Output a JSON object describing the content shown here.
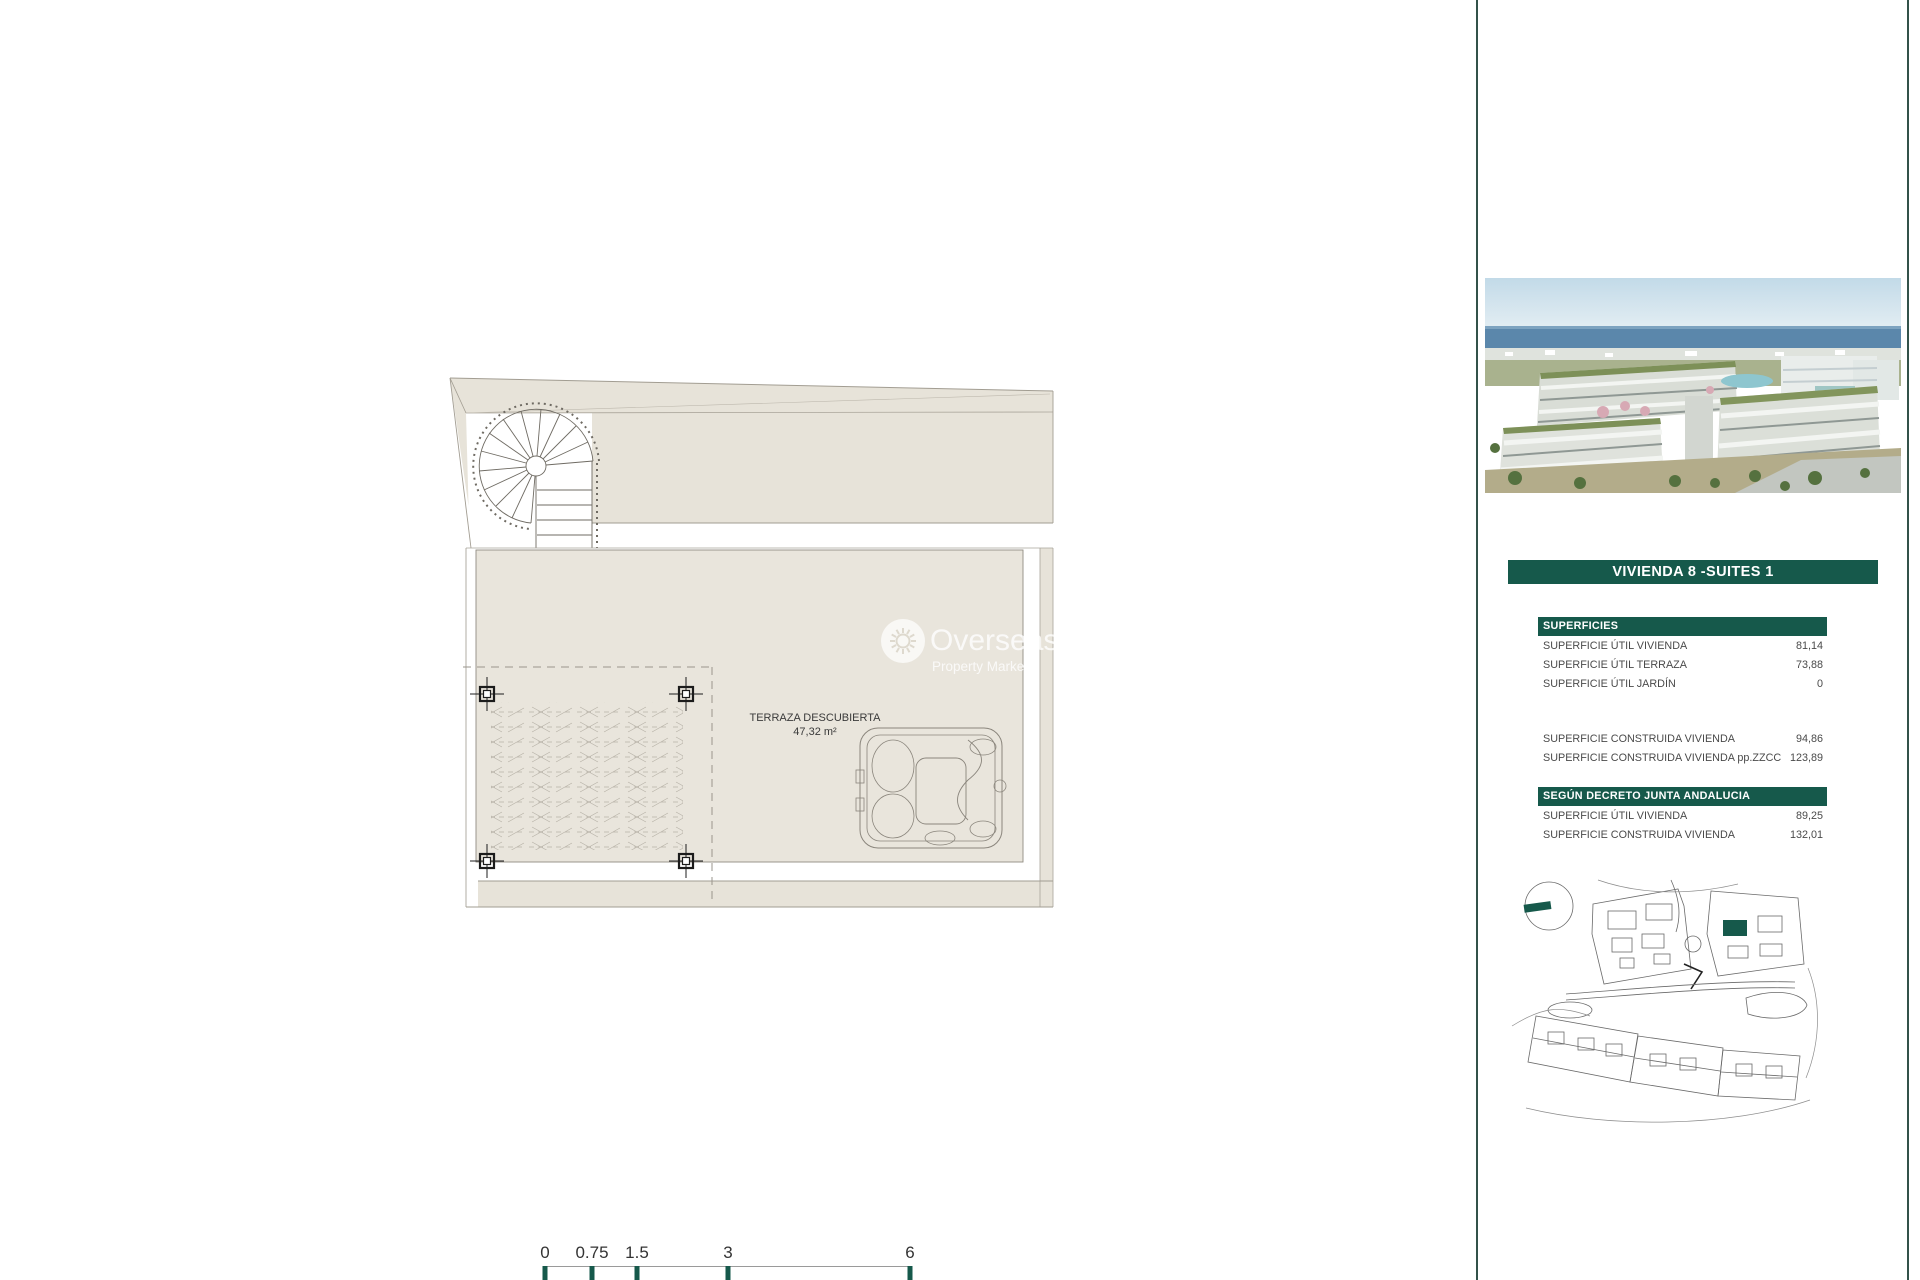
{
  "colors": {
    "accent_green": "#16594b",
    "plan_beige": "#e7e3d9",
    "plan_beige_light": "#e9e5dc",
    "divider_green": "#33524a"
  },
  "plan": {
    "area_label": "TERRAZA DESCUBIERTA",
    "area_value": "47,32 m²"
  },
  "watermark": {
    "line1": "Overseas",
    "line2": "Property Market",
    "icon": "sun-icon"
  },
  "scalebar": {
    "labels": [
      "0",
      "0.75",
      "1.5",
      "3",
      "6"
    ]
  },
  "sidebar": {
    "title": "VIVIENDA 8 -SUITES 1",
    "photo": "aerial-view-of-apartment-development-with-sea",
    "superficies": {
      "header": "SUPERFICIES",
      "rows": [
        {
          "label": "SUPERFICIE ÚTIL VIVIENDA",
          "value": "81,14"
        },
        {
          "label": "SUPERFICIE ÚTIL TERRAZA",
          "value": "73,88"
        },
        {
          "label": "SUPERFICIE ÚTIL JARDÍN",
          "value": "0"
        }
      ],
      "rows2": [
        {
          "label": "SUPERFICIE CONSTRUIDA VIVIENDA",
          "value": "94,86"
        },
        {
          "label": "SUPERFICIE CONSTRUIDA VIVIENDA pp.ZZCC",
          "value": "123,89"
        }
      ]
    },
    "decreto": {
      "header": "SEGÚN DECRETO JUNTA ANDALUCIA",
      "rows": [
        {
          "label": "SUPERFICIE ÚTIL VIVIENDA",
          "value": "89,25"
        },
        {
          "label": "SUPERFICIE CONSTRUIDA VIVIENDA",
          "value": "132,01"
        }
      ]
    },
    "siteplan": "development-site-plan-with-unit-highlight"
  }
}
